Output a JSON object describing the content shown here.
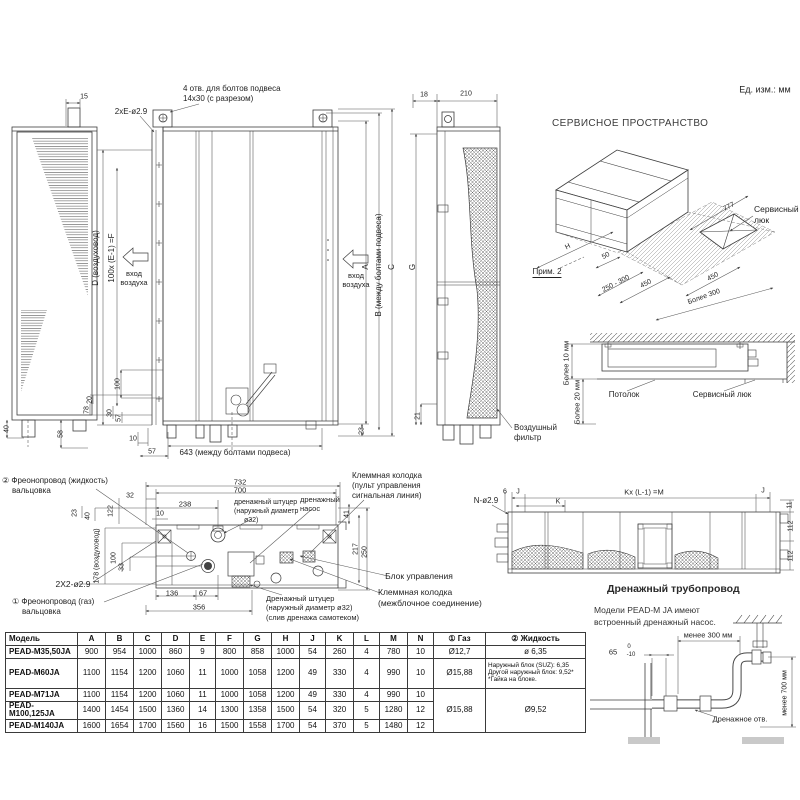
{
  "units_note": "Ед. изм.: мм",
  "front_view": {
    "bolt_note1": "4 отв. для болтов подвеса",
    "bolt_note2": "14x30 (с разрезом)",
    "hole_label": "2xE-ø2.9",
    "dim_15": "15",
    "dim_40": "40",
    "dim_58": "58",
    "duct_d": "D (воздуховод)",
    "pitch_f": "100x (E-1) =F",
    "inlet1": "вход",
    "inlet2": "воздуха",
    "inlet_r1": "вход",
    "inlet_r2": "воздуха",
    "dim_A": "A",
    "dim_B": "B (между болтами подвеса)",
    "dim_C": "C",
    "dim_23": "23",
    "dim_100": "100",
    "dim_20": "20",
    "dim_78": "78",
    "dim_30": "30",
    "dim_57a": "57",
    "dim_10": "10",
    "dim_57b": "57",
    "dim_643": "643 (между болтами подвеса)"
  },
  "side_view": {
    "dim_18": "18",
    "dim_210": "210",
    "dim_G": "G",
    "dim_21": "21",
    "filter1": "Воздушный",
    "filter2": "фильтр"
  },
  "service_space": {
    "title": "СЕРВИСНОЕ ПРОСТРАНСТВО",
    "dim_777": "777",
    "hatch1": "Сервисный",
    "hatch2": "люк",
    "dim_H": "H",
    "note": "Прим. 2",
    "dim_50": "50",
    "dim_250_300": "250 - 300",
    "dim_450a": "450",
    "dim_450b": "450",
    "more_300": "Более 300"
  },
  "ceiling_section": {
    "more_10": "Более 10 мм",
    "more_20": "Более 20 мм",
    "ceiling": "Потолок",
    "hatch": "Сервисный люк"
  },
  "plan_view": {
    "pipe2_1": "② Фреонопровод (жидкость)",
    "pipe2_2": "вальцовка",
    "dim_732": "732",
    "dim_700": "700",
    "dim_238": "238",
    "dim_32": "32",
    "dim_10": "10",
    "dim_23": "23",
    "dim_40": "40",
    "dim_122": "122",
    "dim_178": "178 (воздуховод)",
    "dim_100": "100",
    "dim_33": "33",
    "dim_136": "136",
    "dim_67": "67",
    "dim_356": "356",
    "dim_41": "41",
    "dim_217": "217",
    "dim_250": "250",
    "drain_top1": "дренажный штуцер",
    "drain_top2": "(наружный диаметр",
    "drain_top3": "ø32)",
    "pump1": "дренажный",
    "pump2": "насос",
    "sig1": "Клеммная колодка",
    "sig2": "(пульт управления",
    "sig3": "сигнальная линия)",
    "control_box": "Блок управления",
    "unit1": "Клеммная колодка",
    "unit2": "(межблочное соединение)",
    "drain_bot1": "Дренажный штуцер",
    "drain_bot2": "(наружный диаметр ø32)",
    "drain_bot3": "(слив дренажа самотеком)",
    "holes_label": "2X2-ø2.9",
    "pipe1_1": "① Фреонопровод (газ)",
    "pipe1_2": "вальцовка"
  },
  "top_view": {
    "dim_6": "6",
    "dim_J1": "J",
    "dim_K": "K",
    "dim_KLM": "Kx (L-1) =M",
    "dim_J2": "J",
    "dim_11": "11",
    "dim_112a": "112",
    "dim_112b": "112",
    "holes_label": "N-ø2.9"
  },
  "drain_section": {
    "title": "Дренажный трубопровод",
    "note1": "Модели PEAD-M JA имеют",
    "note2": "встроенный дренажный насос.",
    "dim_less300": "менее 300 мм",
    "dim_65": "65",
    "tol_top": "0",
    "tol_bot": "-10",
    "hole_label": "Дренажное отв.",
    "dim_less700": "менее 700 мм"
  },
  "table": {
    "headers": [
      "Модель",
      "A",
      "B",
      "C",
      "D",
      "E",
      "F",
      "G",
      "H",
      "J",
      "K",
      "L",
      "M",
      "N",
      "① Газ",
      "② Жидкость"
    ],
    "rows": [
      {
        "model": "PEAD-M35,50JA",
        "v": [
          "900",
          "954",
          "1000",
          "860",
          "9",
          "800",
          "858",
          "1000",
          "54",
          "260",
          "4",
          "780",
          "10"
        ],
        "gas": "Ø12,7",
        "liquid": "ø 6,35"
      },
      {
        "model": "PEAD-M60JA",
        "v": [
          "1100",
          "1154",
          "1200",
          "1060",
          "11",
          "1000",
          "1058",
          "1200",
          "49",
          "330",
          "4",
          "990",
          "10"
        ],
        "gas": "Ø15,88",
        "liquid_lines": [
          "Наружный блок (SUZ): 6,35",
          "Другой наружный блок: 9,52*",
          "*Гайка на блоке."
        ]
      },
      {
        "model": "PEAD-M71JA",
        "v": [
          "1100",
          "1154",
          "1200",
          "1060",
          "11",
          "1000",
          "1058",
          "1200",
          "49",
          "330",
          "4",
          "990",
          "10"
        ]
      },
      {
        "model": "PEAD-M100,125JA",
        "v": [
          "1400",
          "1454",
          "1500",
          "1360",
          "14",
          "1300",
          "1358",
          "1500",
          "54",
          "320",
          "5",
          "1280",
          "12"
        ]
      },
      {
        "model": "PEAD-M140JA",
        "v": [
          "1600",
          "1654",
          "1700",
          "1560",
          "16",
          "1500",
          "1558",
          "1700",
          "54",
          "370",
          "5",
          "1480",
          "12"
        ]
      }
    ],
    "merged_gas": "Ø15,88",
    "merged_liquid": "Ø9,52"
  }
}
